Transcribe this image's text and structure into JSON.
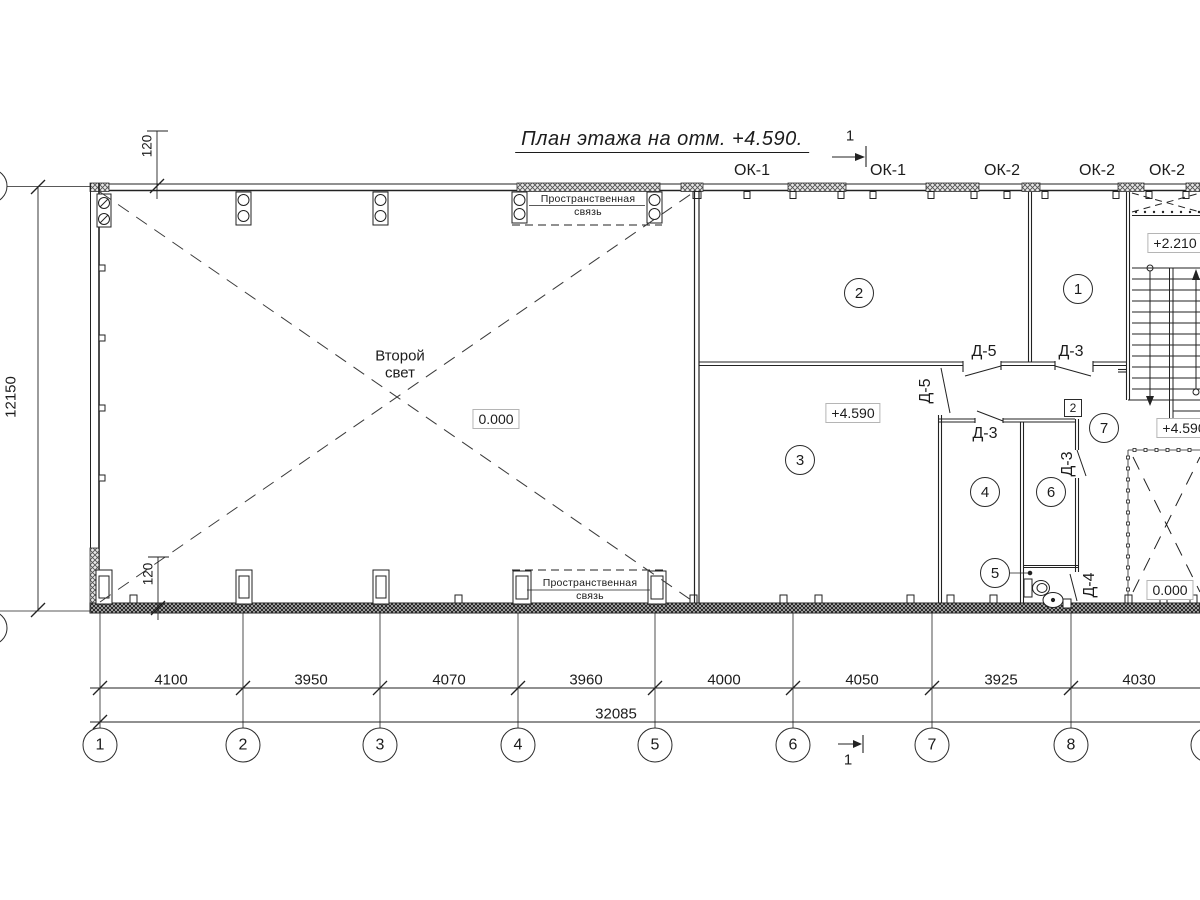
{
  "title": "План этажа на отм. +4.590.",
  "section_marks": {
    "top": "1",
    "bottom": "1"
  },
  "windows": {
    "ok1": "ОК-1",
    "ok2": "ОК-2"
  },
  "hall": {
    "label_line1": "Второй",
    "label_line2": "свет",
    "elevation": "0.000"
  },
  "brace": {
    "line1": "Пространственная",
    "line2": "связь"
  },
  "rooms": [
    "1",
    "2",
    "3",
    "4",
    "5",
    "6",
    "7"
  ],
  "doors": {
    "d3": "Д-3",
    "d4": "Д-4",
    "d5": "Д-5"
  },
  "unit_badge": "2",
  "elevations": {
    "stair_landing": "+2.210",
    "room3": "+4.590",
    "stair_bottom": "+4.590",
    "shaft": "0.000"
  },
  "dimensions": {
    "segments": [
      "4100",
      "3950",
      "4070",
      "3960",
      "4000",
      "4050",
      "3925",
      "4030"
    ],
    "total": "32085",
    "height_left": "12150",
    "wall_offset_top": "120",
    "wall_offset_bottom": "120"
  },
  "axes": [
    "1",
    "2",
    "3",
    "4",
    "5",
    "6",
    "7",
    "8"
  ],
  "line_color": "#222222"
}
